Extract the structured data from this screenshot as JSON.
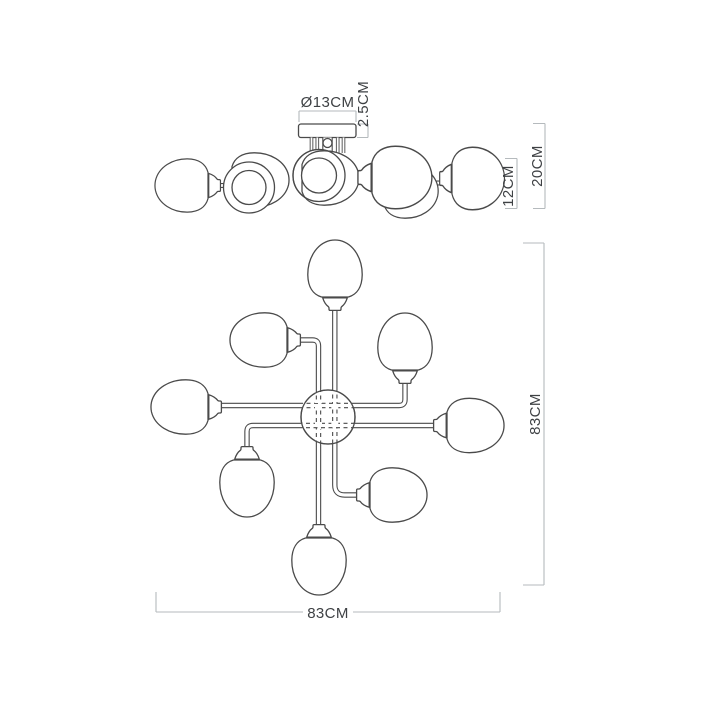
{
  "figure": {
    "type": "technical-dimension-drawing",
    "subject": "8-light ceiling chandelier",
    "lights_depicted": 8,
    "views": [
      "side-elevation",
      "plan-view"
    ]
  },
  "dims": {
    "canopy_diameter": "Ø13CM",
    "canopy_height": "2.5CM",
    "shade_height": "12CM",
    "fixture_height": "20CM",
    "plan_width": "83CM",
    "plan_depth": "83CM"
  },
  "colors": {
    "background": "#ffffff",
    "drawing_line": "#4a4a4a",
    "dimension_line": "#b5babd",
    "dimension_text": "#3e4144"
  }
}
